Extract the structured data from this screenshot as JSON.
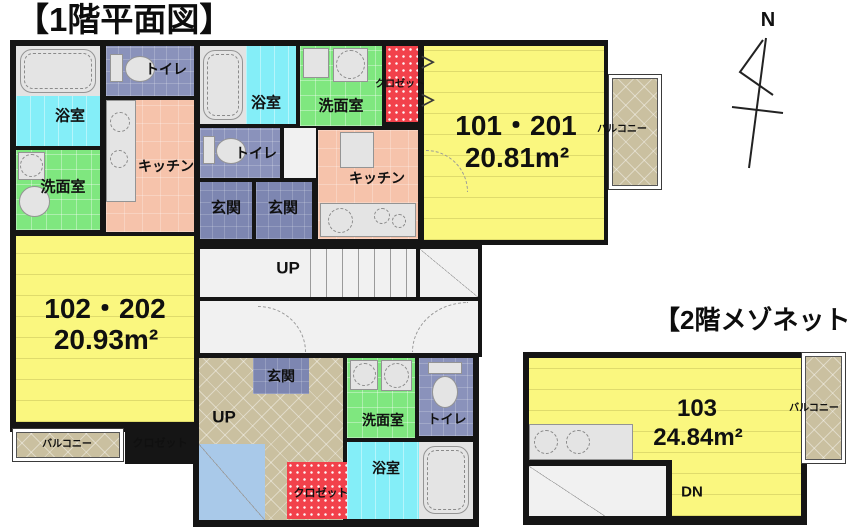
{
  "titles": {
    "floor1": "【1階平面図】",
    "floor2": "【2階メゾネット】"
  },
  "compass": {
    "north": "N"
  },
  "labels": {
    "bathroom": "浴室",
    "washroom": "洗面室",
    "toilet": "トイレ",
    "kitchen": "キッチン",
    "entrance": "玄関",
    "closet": "クロゼット",
    "balcony": "バルコニー",
    "up": "UP",
    "down": "DN"
  },
  "units": {
    "u101_201": {
      "name": "101・201",
      "area": "20.81m²"
    },
    "u102_202": {
      "name": "102・202",
      "area": "20.93m²"
    },
    "u103": {
      "name": "103",
      "area": "24.84m²"
    }
  },
  "icons": {
    "folding_door": "＞"
  },
  "colors": {
    "wall": "#151515",
    "room_yellow": "#FAF77F",
    "kitchen_salmon": "#F6C3AB",
    "washroom_green": "#7FE77F",
    "bath_cyan": "#84EEF8",
    "toilet_purple": "#8A92BB",
    "entrance_blue": "#7D86B1",
    "closet_red": "#F2414B",
    "balcony_tan": "#CAC0A0",
    "stair_blue": "#A9C9E9"
  }
}
